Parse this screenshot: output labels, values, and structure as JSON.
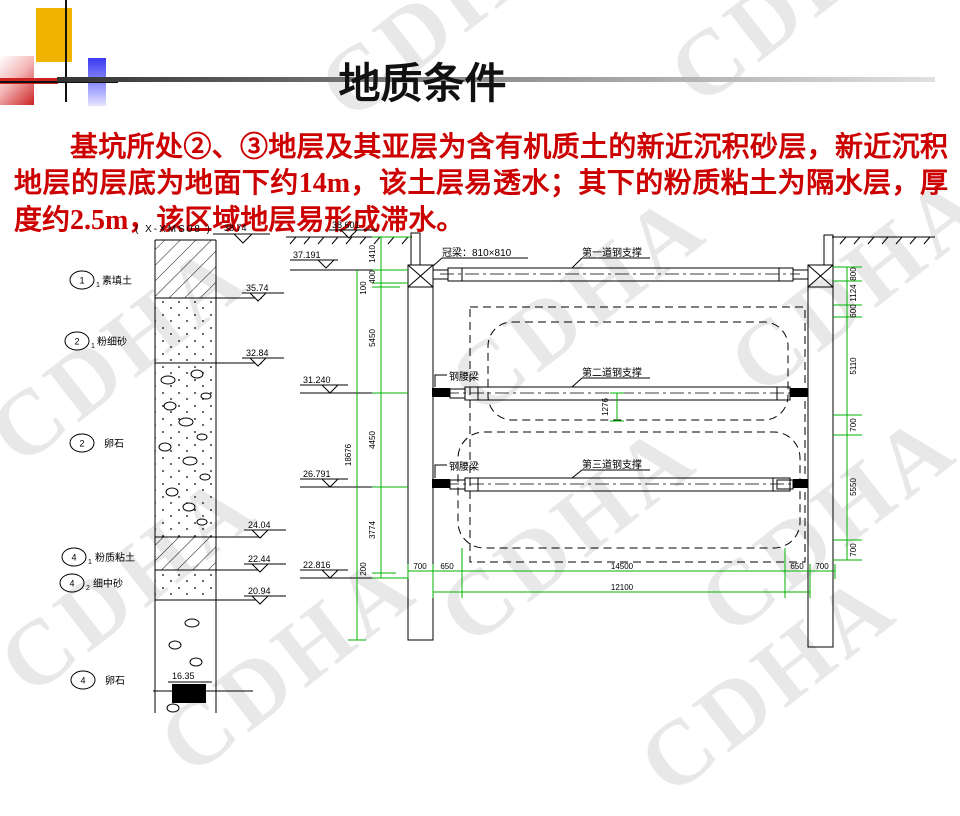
{
  "slide": {
    "title": "地质条件",
    "watermark": "CDHA",
    "paragraph": "基坑所处②、③地层及其亚层为含有机质土的新近沉积砂层，新近沉积地层的层底为地面下约14m，该土层易透水；其下的粉质粘土为隔水层，厚度约2.5m，该区域地层易形成滞水。"
  },
  "colors": {
    "body_text_red": "#cc0000",
    "dimension_green": "#00b300",
    "deco_yellow": "#f0b400",
    "deco_blue": "#3a3aee",
    "deco_red": "#cc2222"
  },
  "borehole": {
    "id_label": "( X-XMS08 )",
    "surface_elevation": "38.74",
    "layers": [
      {
        "num": "1",
        "sub": "1",
        "name": "素填土",
        "bottom_elevation": "35.74"
      },
      {
        "num": "2",
        "sub": "1",
        "name": "粉细砂",
        "bottom_elevation": "32.84"
      },
      {
        "num": "2",
        "sub": "",
        "name": "卵石",
        "bottom_elevation": "24.04"
      },
      {
        "num": "4",
        "sub": "1",
        "name": "粉质粘土",
        "bottom_elevation": "22.44"
      },
      {
        "num": "4",
        "sub": "2",
        "name": "细中砂",
        "bottom_elevation": "20.94"
      },
      {
        "num": "4",
        "sub": "",
        "name": "卵石",
        "bottom_elevation": ""
      }
    ],
    "pit_bottom_mark": "16.35"
  },
  "section": {
    "labels": {
      "crown_beam": "冠梁：810×810",
      "strut1": "第一道钢支撑",
      "strut2": "第二道钢支撑",
      "strut3": "第三道钢支撑",
      "waler2": "钢腰梁",
      "waler3": "钢腰梁"
    },
    "elevations": {
      "ground": "38.601",
      "crown": "37.191",
      "e3": "31.240",
      "e4": "26.791",
      "e5": "22.816"
    },
    "dims_left": {
      "d1": "1410",
      "d2": "400",
      "d3": "100",
      "d4": "5450",
      "d5": "4450",
      "d6": "3774",
      "d7": "200",
      "total": "18676"
    },
    "dims_right": {
      "d1": "800",
      "d2": "1124",
      "d3": "600",
      "d4": "5110",
      "d5": "700",
      "d6": "5550",
      "d7": "700"
    },
    "dims_bottom": {
      "wall_l": "700",
      "edge_l": "650",
      "span": "14500",
      "edge_r": "650",
      "wall_r": "700",
      "total2": "12100"
    },
    "dim_strut_tunnel": "1276"
  }
}
